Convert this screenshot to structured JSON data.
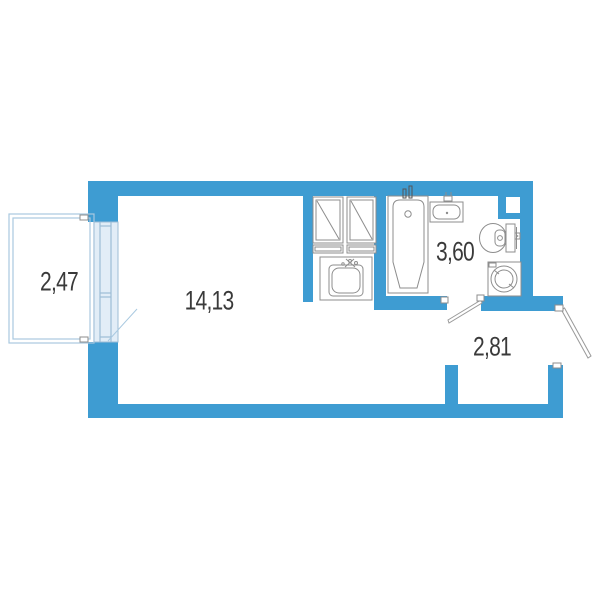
{
  "plan": {
    "rooms": [
      {
        "id": "balcony",
        "area": "2,47"
      },
      {
        "id": "living-room",
        "area": "14,13"
      },
      {
        "id": "bathroom",
        "area": "3,60"
      },
      {
        "id": "hallway",
        "area": "2,81"
      }
    ],
    "fixtures": [
      "wardrobe-unit-left",
      "wardrobe-unit-right",
      "kitchen-sink",
      "bathtub",
      "bathroom-sink",
      "toilet",
      "washing-machine",
      "vent-shaft",
      "balcony-window",
      "balcony-door",
      "bathroom-door",
      "entrance-door"
    ],
    "colors": {
      "wall": "#3E9CD2",
      "text": "#3A3A3A",
      "fixture_line": "#8D8D8D",
      "glazing": "#9DBDD6",
      "glazing_fill": "#E2EDF7",
      "glazing_light": "#A9C9E0"
    }
  }
}
